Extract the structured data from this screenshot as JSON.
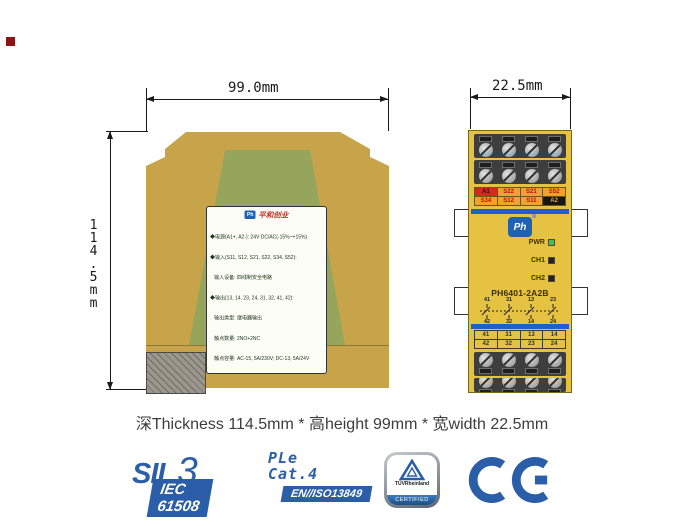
{
  "colors": {
    "accent_blue": "#2B5EA8",
    "housing_yellow": "#E6C243",
    "housing_tan": "#C7A44A",
    "housing_green": "#95A55C",
    "terminal_orange": "#EFA32C",
    "terminal_red": "#D6281E",
    "bar_blue": "#1E5FD0",
    "led_green": "#3CC24E"
  },
  "dimensions": {
    "side_width": "99.0mm",
    "side_height": "114.5mm",
    "front_width": "22.5mm"
  },
  "side_view": {
    "label": {
      "brand_logo": "Ph",
      "brand_text": "平和创业",
      "specs": [
        "◆电源(A1+, A2-): 24V DC/AC(-15%~+15%)",
        "◆输入(S11, S12, S21, S22, S34, S52):",
        "   输入设备: 四线制安全电路",
        "◆输出(13, 14, 23, 24, 31, 32, 41, 42):",
        "   输出类型: 继电器输出",
        "   触点数量: 2NO+2NC",
        "   触点容量: AC-15, 5A/230V; DC-13, 5A/24V",
        "◆响应时间:",
        "   吸合脉冲时间: <200ms",
        "   释放脉冲时间: <20ms",
        "◆复位: 自动复位和手动复位",
        "◆使用温度: -20℃~+60℃"
      ],
      "cert_boxes": [
        {
          "title": "SIL3",
          "body": "IEC 61508"
        },
        {
          "title": "PLe",
          "body": "EN/ISO13849"
        },
        {
          "title": "Cat.4",
          "body": "EN/ISO13849"
        }
      ],
      "company": "北京平和创业科技发展有限公司",
      "service_line": "服务电话: 400-918-6058    Http: www.bjpinghe.com"
    }
  },
  "front_view": {
    "top_terminals": {
      "row1": [
        "A1",
        "S22",
        "S21",
        "S52"
      ],
      "row2": [
        "S34",
        "S12",
        "S11",
        "A2"
      ]
    },
    "leds": [
      {
        "label": "PWR",
        "color": "#3CC24E"
      },
      {
        "label": "CH1",
        "color": "#1d2430"
      },
      {
        "label": "CH2",
        "color": "#1d2430"
      }
    ],
    "model": "PH6401-2A2B",
    "contact_diagram": {
      "top": [
        "41",
        "31",
        "13",
        "23"
      ],
      "bottom": [
        "42",
        "32",
        "14",
        "24"
      ]
    },
    "bottom_terminals": {
      "row1": [
        "41",
        "31",
        "13",
        "14"
      ],
      "row2": [
        "42",
        "32",
        "23",
        "24"
      ]
    }
  },
  "caption": "深Thickness 114.5mm * 高height 99mm * 宽width 22.5mm",
  "footer_certs": {
    "sil": {
      "word": "SIL",
      "number": "3",
      "badge": "IEC 61508"
    },
    "ple": {
      "line1": "PLe",
      "line2": "Cat.4",
      "badge": "EN//ISO13849"
    },
    "tuv": {
      "brand": "TÜVRheinland",
      "band": "CERTIFIED"
    },
    "ce": "CE"
  }
}
